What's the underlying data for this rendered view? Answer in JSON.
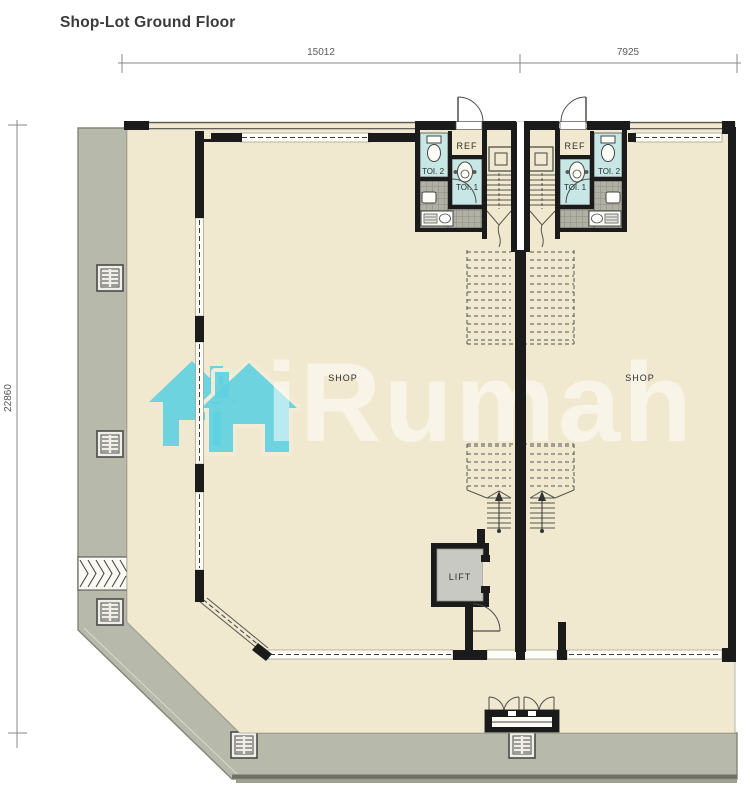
{
  "title": "Shop-Lot Ground Floor",
  "dimensions": {
    "top_left_span": "15012",
    "top_right_span": "7925",
    "left_span": "22860"
  },
  "labels": {
    "shop_left": "SHOP",
    "shop_right": "SHOP",
    "ref_left": "REF",
    "ref_right": "REF",
    "toi1_left": "TOI. 1",
    "toi2_left": "TOI. 2",
    "toi1_right": "TOI. 1",
    "toi2_right": "TOI. 2",
    "lift": "LIFT"
  },
  "watermark": {
    "text": "iRumah"
  },
  "colors": {
    "floor_cream": "#f1e9cf",
    "sidewalk_gray": "#b7b9ab",
    "toilet_teal": "#c7e7e4",
    "tile_gray": "#b0b0a4",
    "wall_black": "#1b1b1b",
    "watermark_teal": "#5ed0e0"
  }
}
